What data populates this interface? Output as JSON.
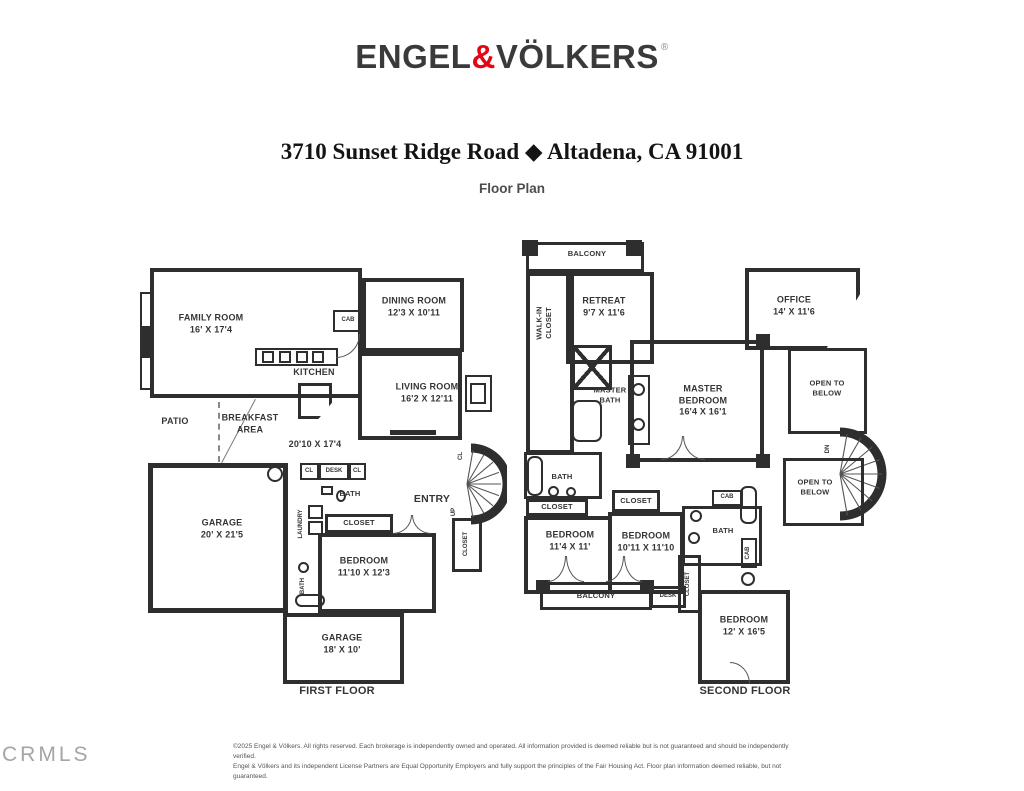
{
  "brand": {
    "name_part1": "ENGEL",
    "ampersand": "&",
    "name_part2": "VÖLKERS",
    "registered": "®",
    "accent_color": "#e30613"
  },
  "header": {
    "address": "3710 Sunset Ridge Road ◆ Altadena, CA 91001",
    "subtitle": "Floor Plan"
  },
  "first_floor": {
    "caption": "FIRST FLOOR",
    "family_room": {
      "name": "FAMILY ROOM",
      "dims": "16' X 17'4"
    },
    "dining_room": {
      "name": "DINING ROOM",
      "dims": "12'3 X 10'11"
    },
    "cab": "CAB",
    "kitchen": "KITCHEN",
    "living_room": {
      "name": "LIVING ROOM",
      "dims": "16'2 X 12'11"
    },
    "kitchen_area_dims": "20'10 X 17'4",
    "patio": "PATIO",
    "breakfast_area": "BREAKFAST AREA",
    "garage": {
      "name": "GARAGE",
      "dims": "20' X 21'5"
    },
    "cl_1": "CL",
    "desk": "DESK",
    "cl_2": "CL",
    "bath_upper": "BATH",
    "laundry": "LAUNDRY",
    "closet_bedroom": "CLOSET",
    "bedroom": {
      "name": "BEDROOM",
      "dims": "11'10 X 12'3"
    },
    "bath_lower": "BATH",
    "entry": "ENTRY",
    "cl_stairs": "CL",
    "up": "UP",
    "closet_entry": "CLOSET",
    "garage_rear": {
      "name": "GARAGE",
      "dims": "18' X 10'"
    }
  },
  "second_floor": {
    "caption": "SECOND FLOOR",
    "balcony_top": "BALCONY",
    "walk_in_closet": "WALK-IN\nCLOSET",
    "retreat": {
      "name": "RETREAT",
      "dims": "9'7 X 11'6"
    },
    "master_bath": "MASTER BATH",
    "master_bedroom": {
      "name": "MASTER BEDROOM",
      "dims": "16'4 X 16'1"
    },
    "office": {
      "name": "OFFICE",
      "dims": "14' X 11'6"
    },
    "open_to_below_upper": "OPEN TO BELOW",
    "open_to_below_lower": "OPEN TO BELOW",
    "dn": "DN",
    "bath_hall": "BATH",
    "closet_hall": "CLOSET",
    "bedroom_1": {
      "name": "BEDROOM",
      "dims": "11'4 X 11'"
    },
    "closet_2": "CLOSET",
    "bedroom_2": {
      "name": "BEDROOM",
      "dims": "10'11 X 11'10"
    },
    "cab_1": "CAB",
    "bath_2": "BATH",
    "cab_2": "CAB",
    "balcony_bottom": "BALCONY",
    "desk": "DESK",
    "closet_3": "CLOSET",
    "bedroom_3": {
      "name": "BEDROOM",
      "dims": "12' X 16'5"
    }
  },
  "watermark": "CRMLS",
  "footer": {
    "line1": "©2025 Engel & Völkers. All rights reserved. Each brokerage is independently owned and operated. All information provided is deemed reliable but is not guaranteed and should be independently verified.",
    "line2": "Engel & Völkers and its independent License Partners are Equal Opportunity Employers and fully support the principles of the Fair Housing Act. Floor plan information deemed reliable, but not guaranteed."
  }
}
